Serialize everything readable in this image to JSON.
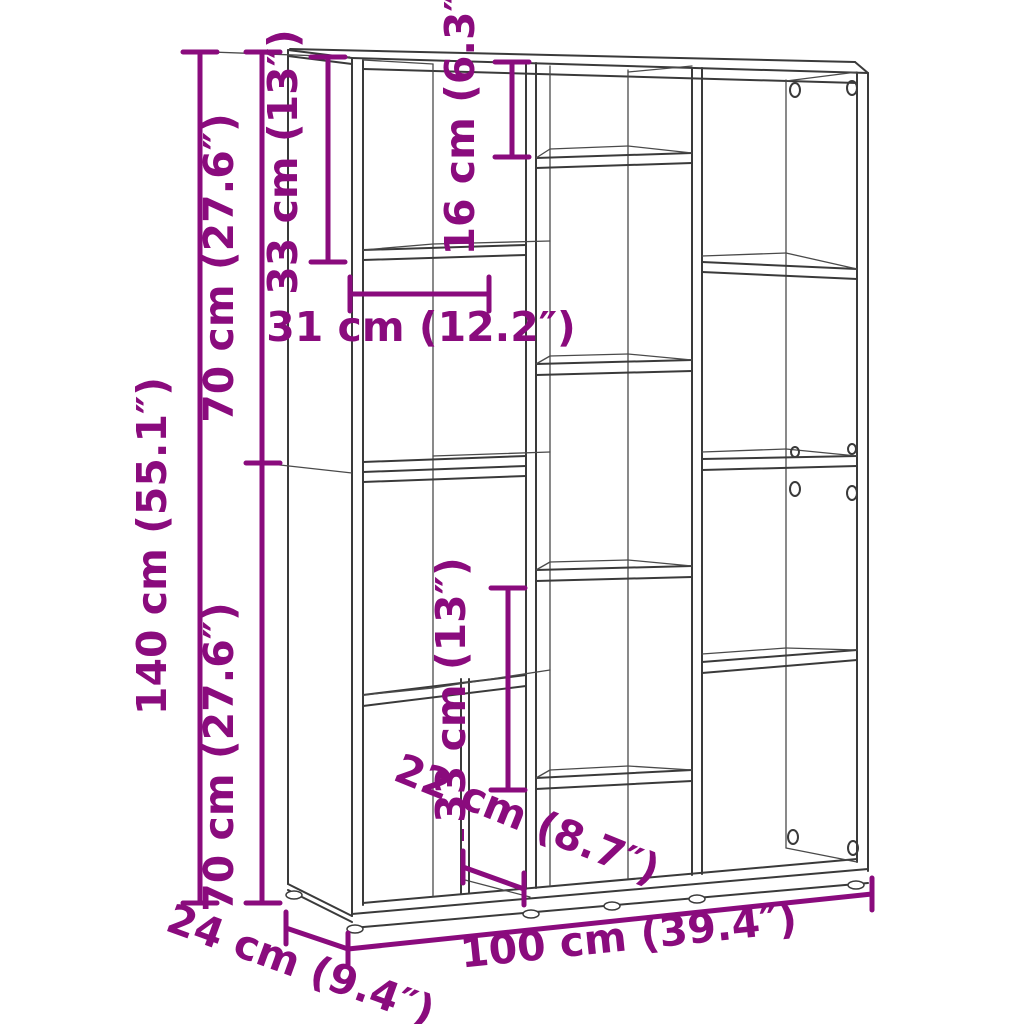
{
  "diagram": {
    "type": "product-dimension-drawing",
    "product": "bookcase-room-divider",
    "accent_color": "#8A0B7D",
    "line_color": "#3a3a3a",
    "background_color": "#ffffff",
    "dimensions": {
      "total_height": "140 cm (55.1″)",
      "upper_section_height": "70 cm (27.6″)",
      "lower_section_height": "70 cm (27.6″)",
      "top_compartment_height": "33 cm (13″)",
      "small_compartment_height": "16 cm (6.3″)",
      "compartment_width": "31 cm (12.2″)",
      "lower_compartment_height": "33 cm (13″)",
      "bottom_compartment_width": "22 cm (8.7″)",
      "total_width": "100 cm (39.4″)",
      "depth": "24 cm (9.4″)"
    }
  }
}
